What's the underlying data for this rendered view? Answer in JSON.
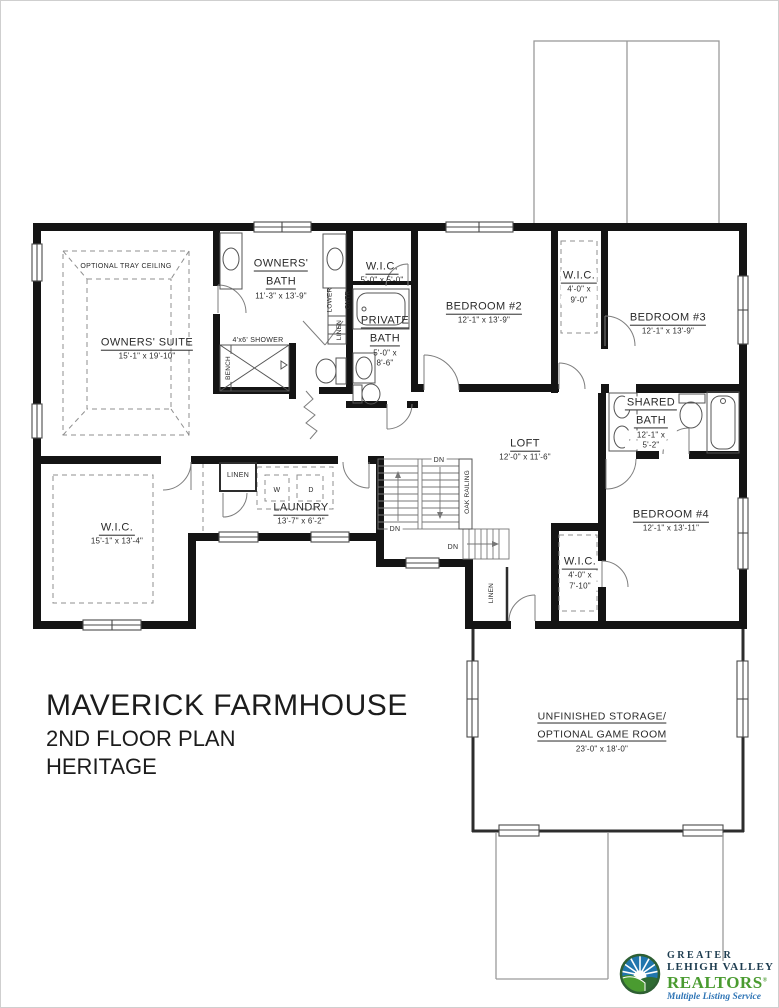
{
  "title_block": {
    "project": "MAVERICK FARMHOUSE",
    "floor": "2ND FLOOR PLAN",
    "elevation": "HERITAGE"
  },
  "rooms": {
    "owners_suite": {
      "name": "OWNERS' SUITE",
      "dims": "15'-1\" x 19'-10\""
    },
    "optional_tray_ceiling": {
      "name": "OPTIONAL TRAY CEILING"
    },
    "owners_bath": {
      "line1": "OWNERS'",
      "line2": "BATH",
      "dims": "11'-3\" x 13'-9\""
    },
    "shower": {
      "name": "4'x6' SHOWER"
    },
    "bench": {
      "name": "BENCH"
    },
    "lower_cntr": {
      "line1": "LOWER",
      "line2": "CNTR"
    },
    "linen_bath": {
      "name": "LINEN"
    },
    "wic_hall": {
      "name": "W.I.C.",
      "dims": "5'-0\" x 5'-0\""
    },
    "private_bath": {
      "line1": "PRIVATE",
      "line2": "BATH",
      "dims1": "5'-0\" x",
      "dims2": "8'-6\""
    },
    "bedroom_2": {
      "name": "BEDROOM #2",
      "dims": "12'-1\" x 13'-9\""
    },
    "wic_bed3": {
      "name": "W.I.C.",
      "dims1": "4'-0\" x",
      "dims2": "9'-0\""
    },
    "bedroom_3": {
      "name": "BEDROOM #3",
      "dims": "12'-1\" x 13'-9\""
    },
    "shared_bath": {
      "line1": "SHARED",
      "line2": "BATH",
      "dims1": "12'-1\" x",
      "dims2": "5'-2\""
    },
    "loft": {
      "name": "LOFT",
      "dims": "12'-0\" x 11'-6\""
    },
    "oak_railing": {
      "name": "OAK RAILING"
    },
    "stairs": {
      "dn": "DN"
    },
    "linen_laundry": {
      "name": "LINEN"
    },
    "laundry": {
      "name": "LAUNDRY",
      "dims": "13'-7\" x 6'-2\"",
      "washer": "W",
      "dryer": "D"
    },
    "wic_owners": {
      "name": "W.I.C.",
      "dims": "15'-1\" x 13'-4\""
    },
    "bedroom_4": {
      "name": "BEDROOM #4",
      "dims": "12'-1\" x 13'-11\""
    },
    "wic_bed4": {
      "name": "W.I.C.",
      "dims1": "4'-0\" x",
      "dims2": "7'-10\""
    },
    "linen_stairs": {
      "name": "LINEN"
    },
    "storage": {
      "line1": "UNFINISHED STORAGE/",
      "line2": "OPTIONAL GAME ROOM",
      "dims": "23'-0\" x 18'-0\""
    }
  },
  "logo": {
    "org_line1": "GREATER",
    "org_line2": "LEHIGH VALLEY",
    "org_line3": "REALTORS",
    "registered": "®",
    "tagline": "Multiple Listing Service",
    "colors": {
      "navy": "#1d3c4f",
      "green": "#4a9b30",
      "blue": "#2e74b5"
    }
  },
  "plan_colors": {
    "wall": "#141414",
    "thin": "#8f8f8f",
    "fixture": "#555555",
    "text": "#2a2a2a"
  }
}
